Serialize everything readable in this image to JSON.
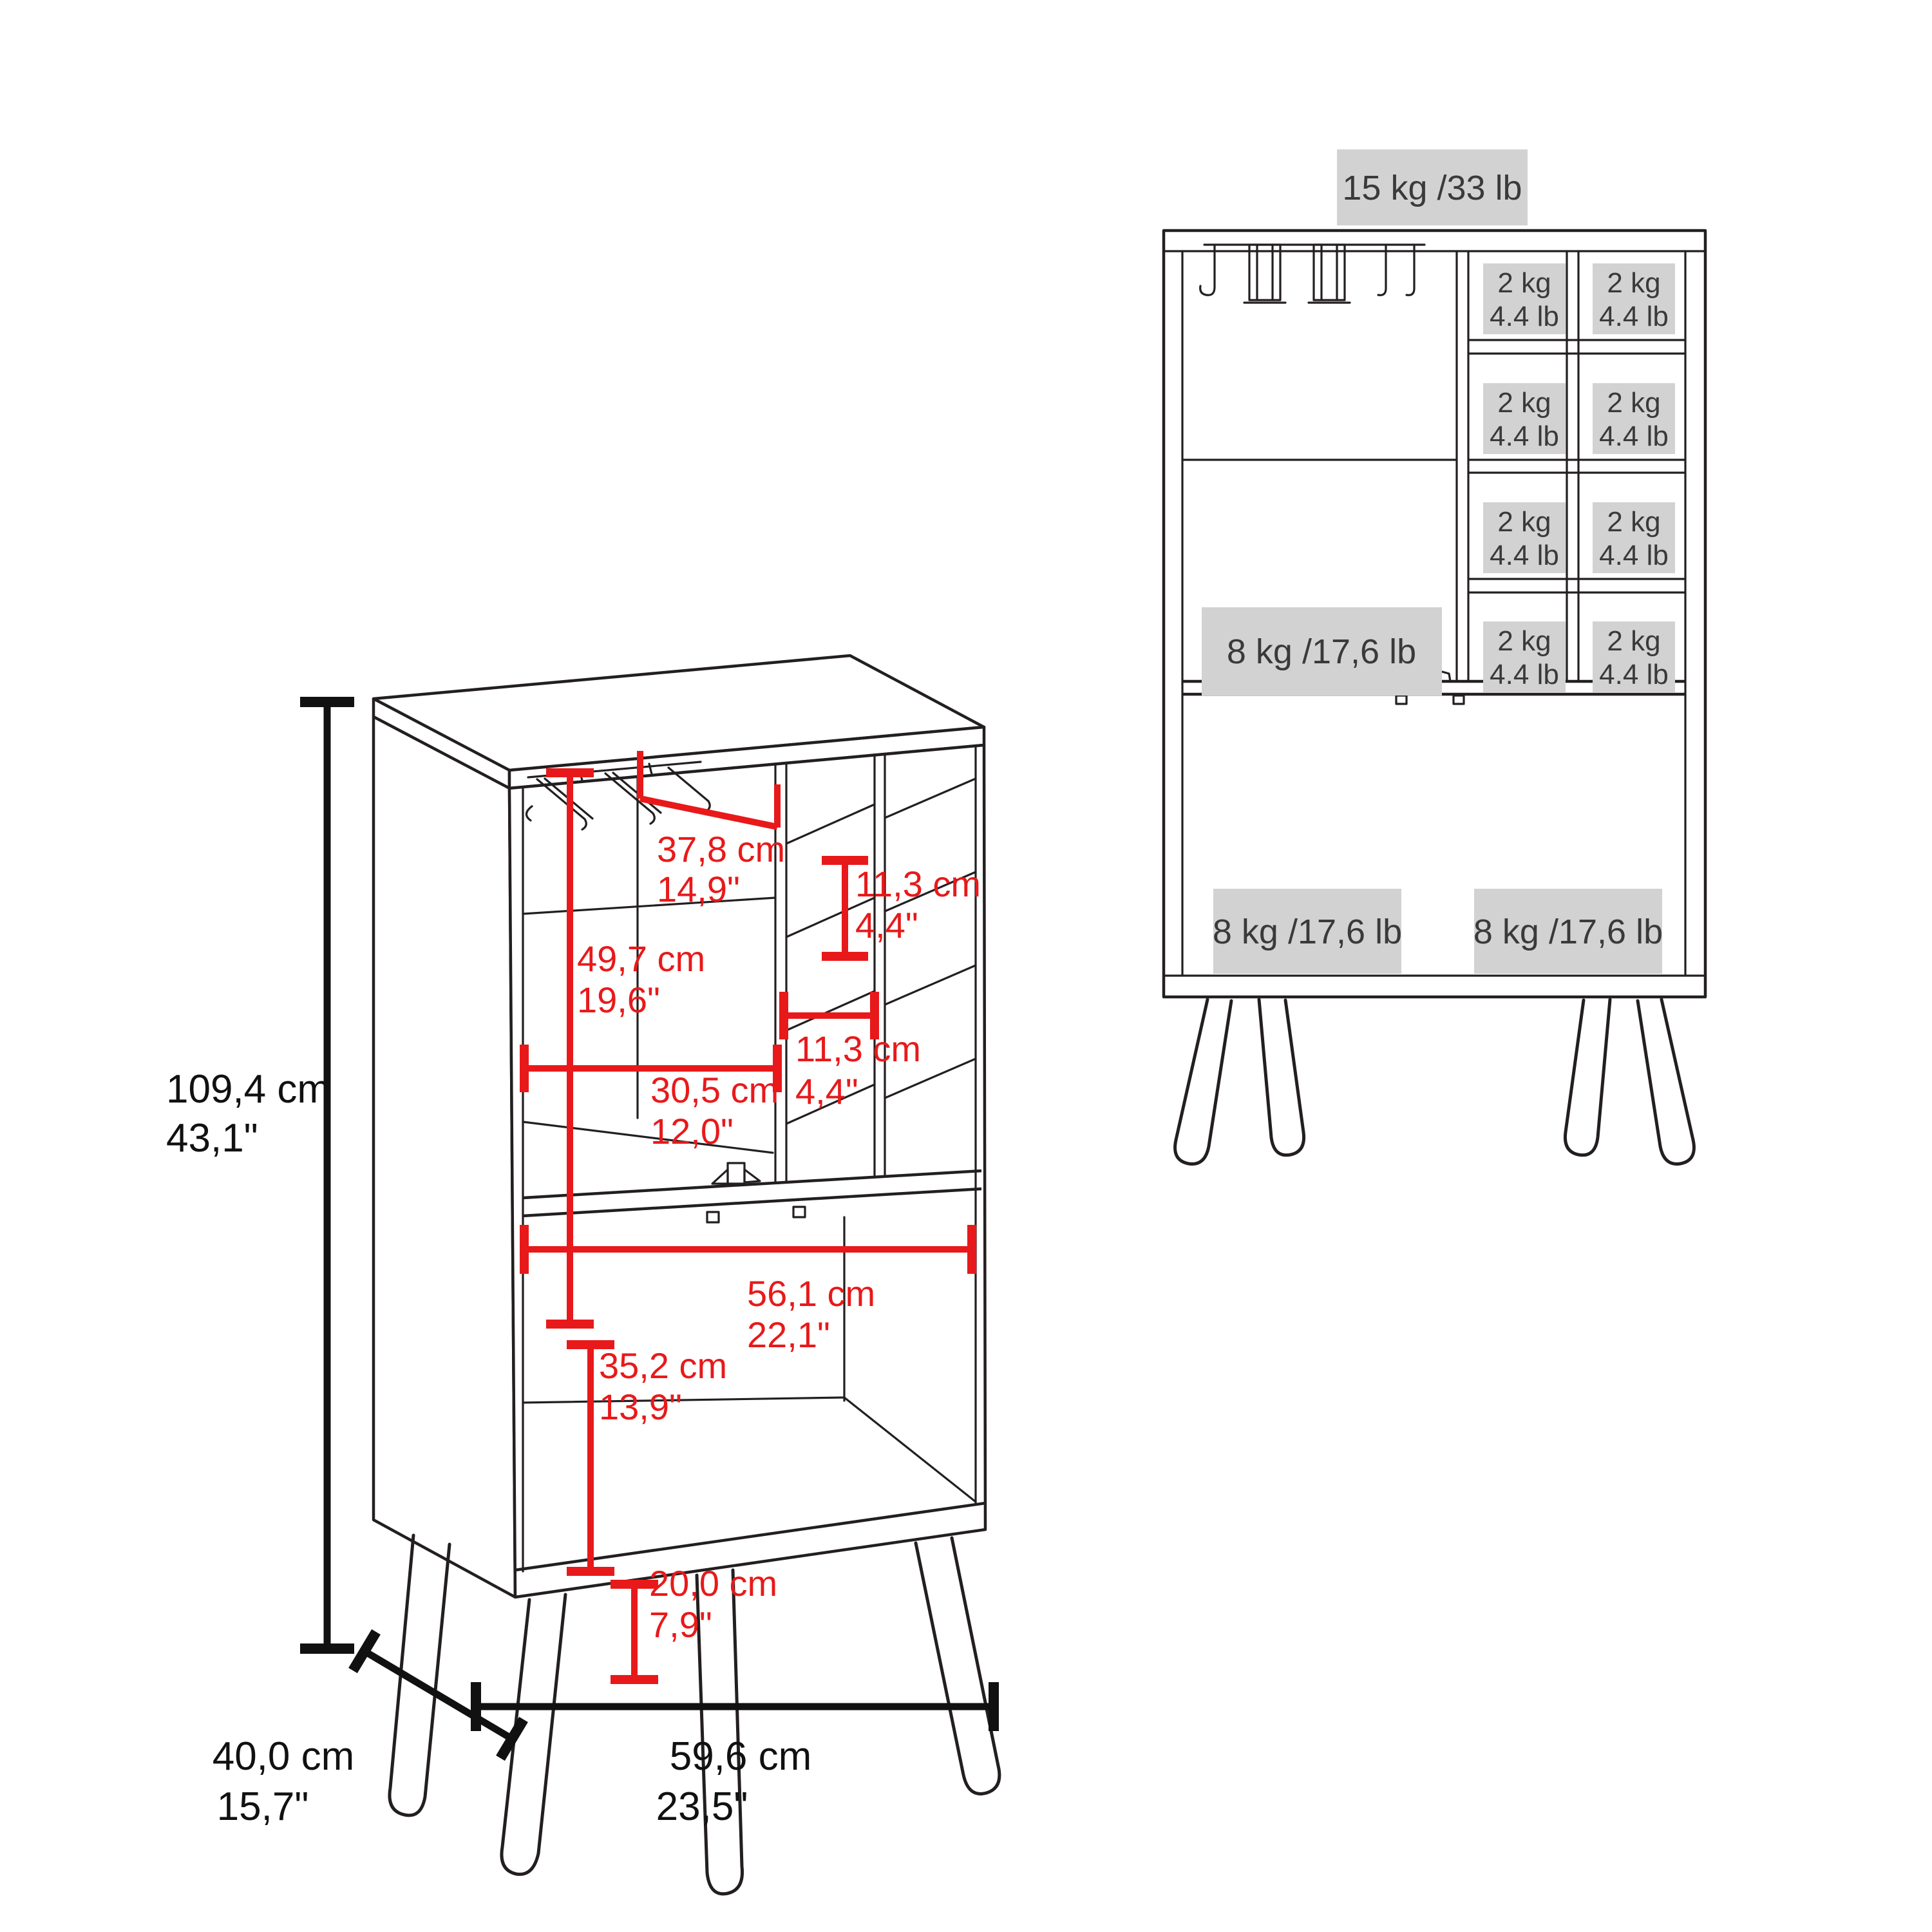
{
  "colors": {
    "dimension_red": "#e8191a",
    "line_color": "#231f20",
    "label_background": "#d2d2d2",
    "label_text": "#3a3a3a"
  },
  "left_view": {
    "height": {
      "cm": "109,4 cm",
      "in": "43,1\""
    },
    "rack_width": {
      "cm": "37,8 cm",
      "in": "14,9\""
    },
    "upper_section_height": {
      "cm": "49,7 cm",
      "in": "19,6\""
    },
    "cubby_height": {
      "cm": "11,3 cm",
      "in": "4,4\""
    },
    "upper_section_width": {
      "cm": "30,5 cm",
      "in": "12,0\""
    },
    "cubby_width": {
      "cm": "11,3 cm",
      "in": "4,4\""
    },
    "lower_section_width": {
      "cm": "56,1 cm",
      "in": "22,1\""
    },
    "lower_section_height": {
      "cm": "35,2 cm",
      "in": "13,9\""
    },
    "leg_height": {
      "cm": "20,0 cm",
      "in": "7,9\""
    },
    "depth": {
      "cm": "40,0 cm",
      "in": "15,7\""
    },
    "width": {
      "cm": "59,6 cm",
      "in": "23,5\""
    }
  },
  "right_view": {
    "top_capacity": "15 kg /33 lb",
    "shelf_capacity": "8 kg /17,6 lb",
    "bottom_left_capacity": "8 kg /17,6 lb",
    "bottom_right_capacity": "8 kg /17,6 lb",
    "cells": [
      {
        "kg": "2 kg",
        "lb": "4.4 lb"
      },
      {
        "kg": "2 kg",
        "lb": "4.4 lb"
      },
      {
        "kg": "2 kg",
        "lb": "4.4 lb"
      },
      {
        "kg": "2 kg",
        "lb": "4.4 lb"
      },
      {
        "kg": "2 kg",
        "lb": "4.4 lb"
      },
      {
        "kg": "2 kg",
        "lb": "4.4 lb"
      },
      {
        "kg": "2 kg",
        "lb": "4.4 lb"
      },
      {
        "kg": "2 kg",
        "lb": "4.4 lb"
      }
    ]
  }
}
